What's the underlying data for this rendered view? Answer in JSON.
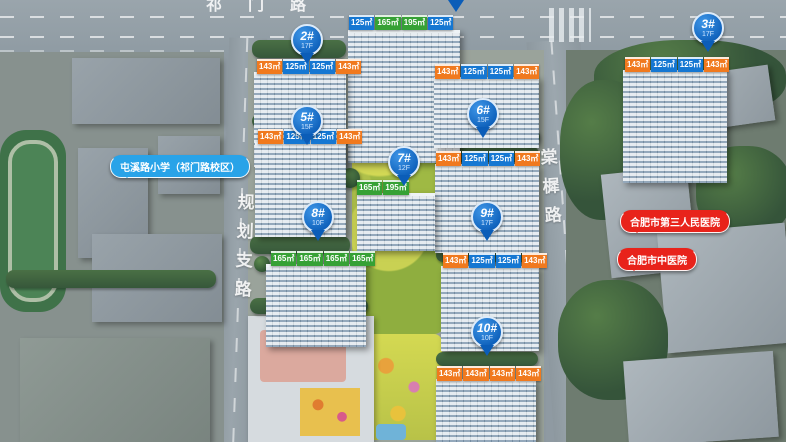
{
  "roads": {
    "top": "祁门路",
    "left": "规划支路",
    "right": "棠樨路"
  },
  "landmarks": {
    "school": "屯溪路小学（祁门路校区）",
    "hospital_third": "合肥市第三人民医院",
    "hospital_tcm": "合肥市中医院"
  },
  "pins": [
    {
      "id": "2#",
      "floors": "17F"
    },
    {
      "id": "3#",
      "floors": "17F"
    },
    {
      "id": "5#",
      "floors": "15F"
    },
    {
      "id": "6#",
      "floors": "15F"
    },
    {
      "id": "7#",
      "floors": "12F"
    },
    {
      "id": "8#",
      "floors": "10F"
    },
    {
      "id": "9#",
      "floors": "17F"
    },
    {
      "id": "10#",
      "floors": "10F"
    }
  ],
  "colors": {
    "pin_blue": "#0b5db8",
    "tag_blue": "#1577d2",
    "tag_orange": "#f0791e",
    "tag_green": "#36a135",
    "bubble_blue": "#29a3e8",
    "bubble_red": "#e8231b"
  },
  "tag_rows": [
    {
      "name": "building-1-top-center",
      "tags": [
        {
          "text": "125㎡",
          "color": "blue"
        },
        {
          "text": "165㎡",
          "color": "green"
        },
        {
          "text": "195㎡",
          "color": "green"
        },
        {
          "text": "125㎡",
          "color": "blue"
        }
      ]
    },
    {
      "name": "building-2",
      "tags": [
        {
          "text": "143㎡",
          "color": "orange"
        },
        {
          "text": "125㎡",
          "color": "blue"
        },
        {
          "text": "125㎡",
          "color": "blue"
        },
        {
          "text": "143㎡",
          "color": "orange"
        }
      ]
    },
    {
      "name": "building-3",
      "tags": [
        {
          "text": "143㎡",
          "color": "orange"
        },
        {
          "text": "125㎡",
          "color": "blue"
        },
        {
          "text": "125㎡",
          "color": "blue"
        },
        {
          "text": "143㎡",
          "color": "orange"
        }
      ]
    },
    {
      "name": "building-mid-right-upper",
      "tags": [
        {
          "text": "143㎡",
          "color": "orange"
        },
        {
          "text": "125㎡",
          "color": "blue"
        },
        {
          "text": "125㎡",
          "color": "blue"
        },
        {
          "text": "143㎡",
          "color": "orange"
        }
      ]
    },
    {
      "name": "building-5",
      "tags": [
        {
          "text": "143㎡",
          "color": "orange"
        },
        {
          "text": "125㎡",
          "color": "blue"
        },
        {
          "text": "125㎡",
          "color": "blue"
        },
        {
          "text": "143㎡",
          "color": "orange"
        }
      ]
    },
    {
      "name": "building-6",
      "tags": [
        {
          "text": "143㎡",
          "color": "orange"
        },
        {
          "text": "125㎡",
          "color": "blue"
        },
        {
          "text": "125㎡",
          "color": "blue"
        },
        {
          "text": "143㎡",
          "color": "orange"
        }
      ]
    },
    {
      "name": "building-7",
      "tags": [
        {
          "text": "165㎡",
          "color": "green"
        },
        {
          "text": "195㎡",
          "color": "green"
        }
      ]
    },
    {
      "name": "building-8",
      "tags": [
        {
          "text": "165㎡",
          "color": "green"
        },
        {
          "text": "165㎡",
          "color": "green"
        },
        {
          "text": "165㎡",
          "color": "green"
        },
        {
          "text": "165㎡",
          "color": "green"
        }
      ]
    },
    {
      "name": "building-9",
      "tags": [
        {
          "text": "143㎡",
          "color": "orange"
        },
        {
          "text": "125㎡",
          "color": "blue"
        },
        {
          "text": "125㎡",
          "color": "blue"
        },
        {
          "text": "143㎡",
          "color": "orange"
        }
      ]
    },
    {
      "name": "building-10",
      "tags": [
        {
          "text": "143㎡",
          "color": "orange"
        },
        {
          "text": "143㎡",
          "color": "orange"
        },
        {
          "text": "143㎡",
          "color": "orange"
        },
        {
          "text": "143㎡",
          "color": "orange"
        }
      ]
    }
  ]
}
